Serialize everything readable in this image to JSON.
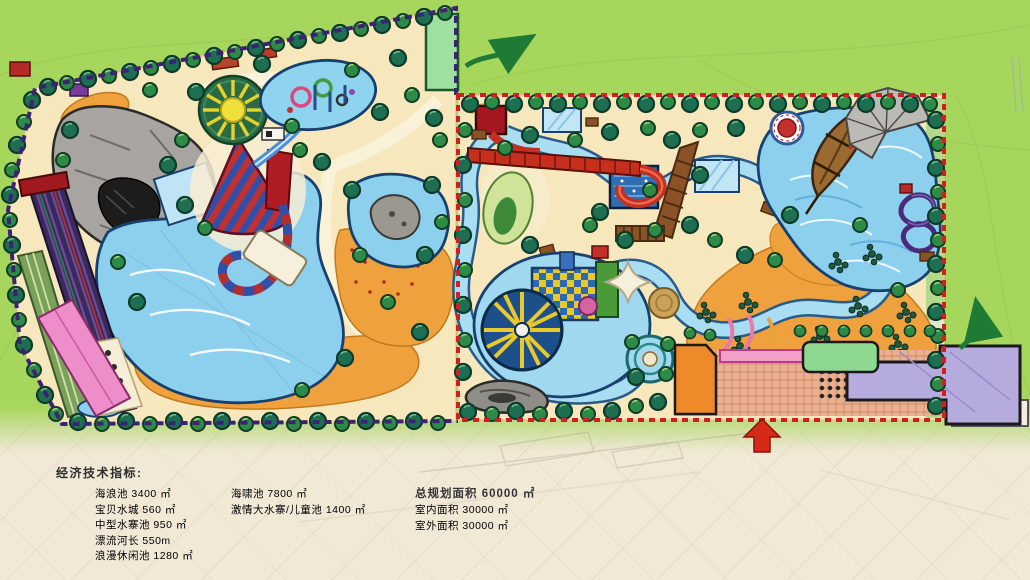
{
  "legend": {
    "title": "经济技术指标:",
    "col1": [
      "海浪池 3400 ㎡",
      "宝贝水城 560 ㎡",
      "中型水寨池 950 ㎡",
      "漂流河长 550m",
      "浪漫休闲池 1280 ㎡"
    ],
    "col2": [
      "海啸池 7800 ㎡",
      "激情大水寨/儿童池 1400 ㎡"
    ],
    "col3_title": "总规划面积 60000 ㎡",
    "col3": [
      "室内面积 30000 ㎡",
      "室外面积 30000 ㎡"
    ]
  },
  "colors": {
    "grass": "#a7d65c",
    "paper": "#f1e8d6",
    "sand": "#f6e7bd",
    "beach_orange": "#efa13d",
    "water": "#8cd0ee",
    "water_deep": "#2f6db5",
    "outdoor_boundary": "#3d2273",
    "indoor_boundary": "#cf1f1f",
    "tree_dark": "#1e6e52",
    "tree_light": "#2e8b47",
    "slide_red": "#c5301e",
    "building_pink": "#ee8ec9",
    "building_orange": "#ef8a2a",
    "building_green": "#8fd890",
    "building_lavender": "#b6abdd",
    "arrow_green": "#1e7a35",
    "arrow_red": "#d52a18"
  }
}
